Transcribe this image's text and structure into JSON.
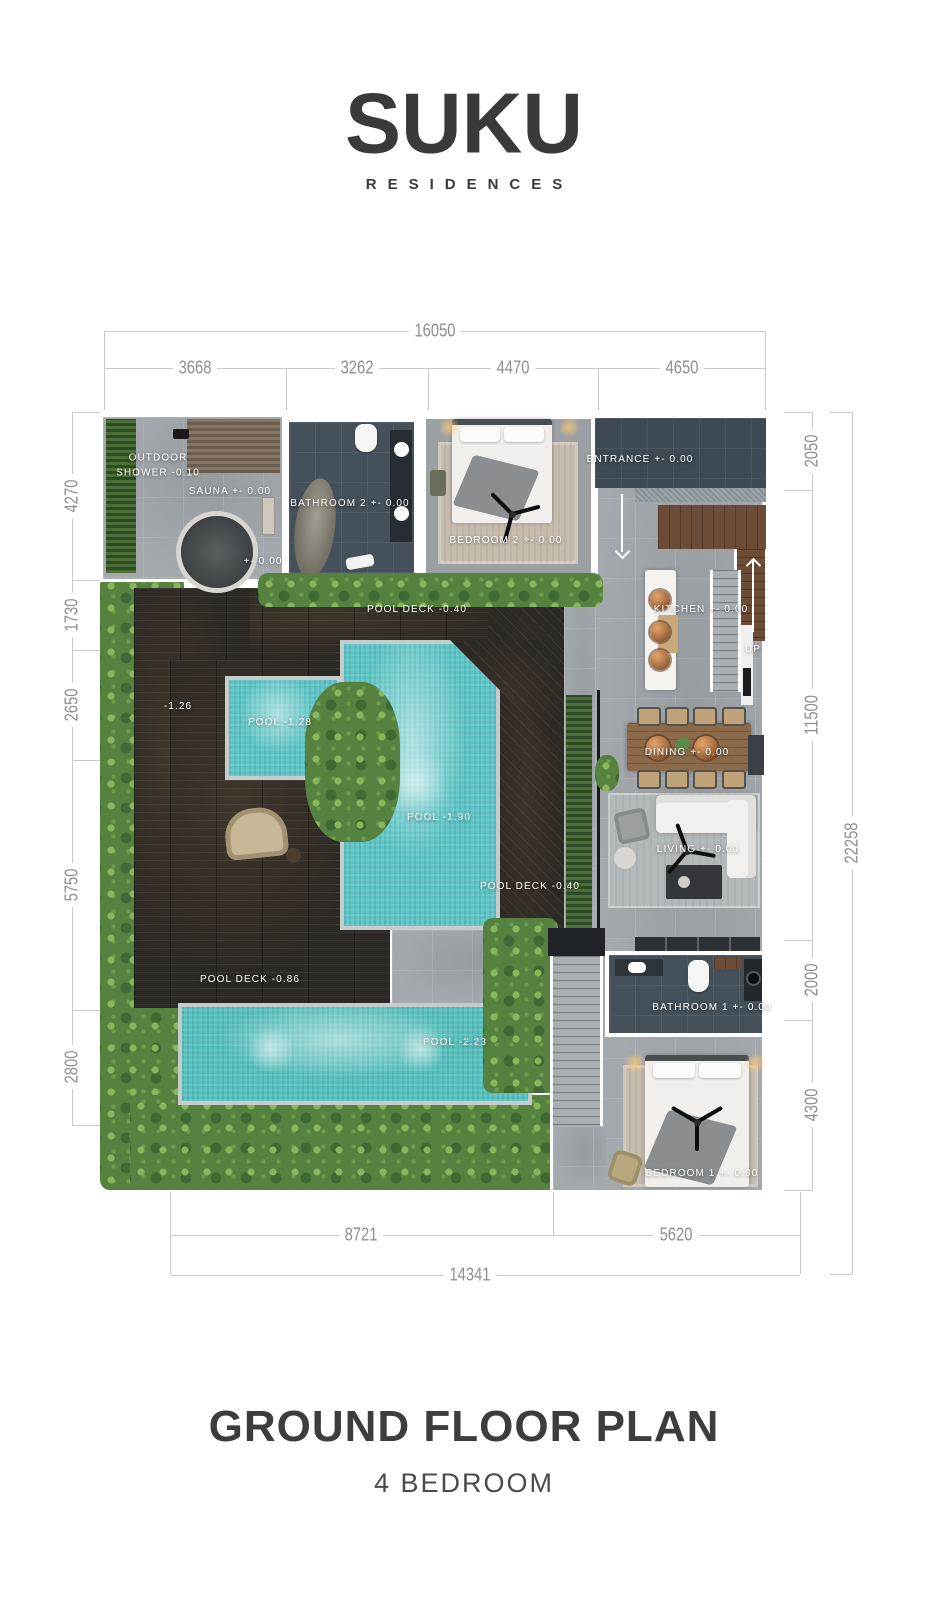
{
  "brand": {
    "logo": "SUKU",
    "tagline": "RESIDENCES"
  },
  "footer": {
    "title": "GROUND FLOOR PLAN",
    "subtitle": "4 BEDROOM"
  },
  "dims": {
    "top": {
      "total": "16050",
      "segments": [
        "3668",
        "3262",
        "4470",
        "4650"
      ]
    },
    "left": {
      "segments": [
        "4270",
        "1730",
        "2650",
        "5750",
        "2800"
      ]
    },
    "right": {
      "total": "22258",
      "segments": [
        "2050",
        "11500",
        "2000",
        "4300"
      ]
    },
    "bottom": {
      "total": "14341",
      "segments": [
        "8721",
        "5620"
      ]
    }
  },
  "rooms": {
    "outdoor_shower": {
      "label": "OUTDOOR SHOWER",
      "level": "-0.10"
    },
    "sauna": {
      "label": "SAUNA",
      "level": "+- 0.00"
    },
    "plunge": {
      "level": "+- 0.00"
    },
    "bathroom2": {
      "label": "BATHROOM 2",
      "level": "+- 0.00"
    },
    "bedroom2": {
      "label": "BEDROOM 2",
      "level": "+- 0.00"
    },
    "entrance": {
      "label": "ENTRANCE",
      "level": "+- 0.00"
    },
    "kitchen": {
      "label": "KITCHEN",
      "level": "+- 0.00"
    },
    "stairs": {
      "up": "UP"
    },
    "dining": {
      "label": "DINING",
      "level": "+- 0.00"
    },
    "living": {
      "label": "LIVING",
      "level": "+- 0.00"
    },
    "pool_deck_top": {
      "label": "POOL DECK",
      "level": "-0.40"
    },
    "deck_ledge": {
      "level": "-1.26"
    },
    "pool_kids": {
      "label": "POOL",
      "level": "-1.28"
    },
    "pool_main": {
      "label": "POOL",
      "level": "-1.90"
    },
    "pool_deck_right": {
      "label": "POOL DECK",
      "level": "-0.40"
    },
    "pool_deck_lower": {
      "label": "POOL DECK",
      "level": "-0.86"
    },
    "pool_lap": {
      "label": "POOL",
      "level": "-2.23"
    },
    "bathroom1": {
      "label": "BATHROOM 1",
      "level": "+- 0.00"
    },
    "bedroom1": {
      "label": "BEDROOM 1",
      "level": "+- 0.00"
    }
  },
  "colors": {
    "pool_water": "#60c5c6",
    "deck_dark": "#2c2823",
    "slate_tile": "#44505a",
    "concrete_floor": "#a4a9ad",
    "foliage_green": "#55823f",
    "dimension_text": "#8f8f8f",
    "logo_ink": "#3a3a3a"
  }
}
